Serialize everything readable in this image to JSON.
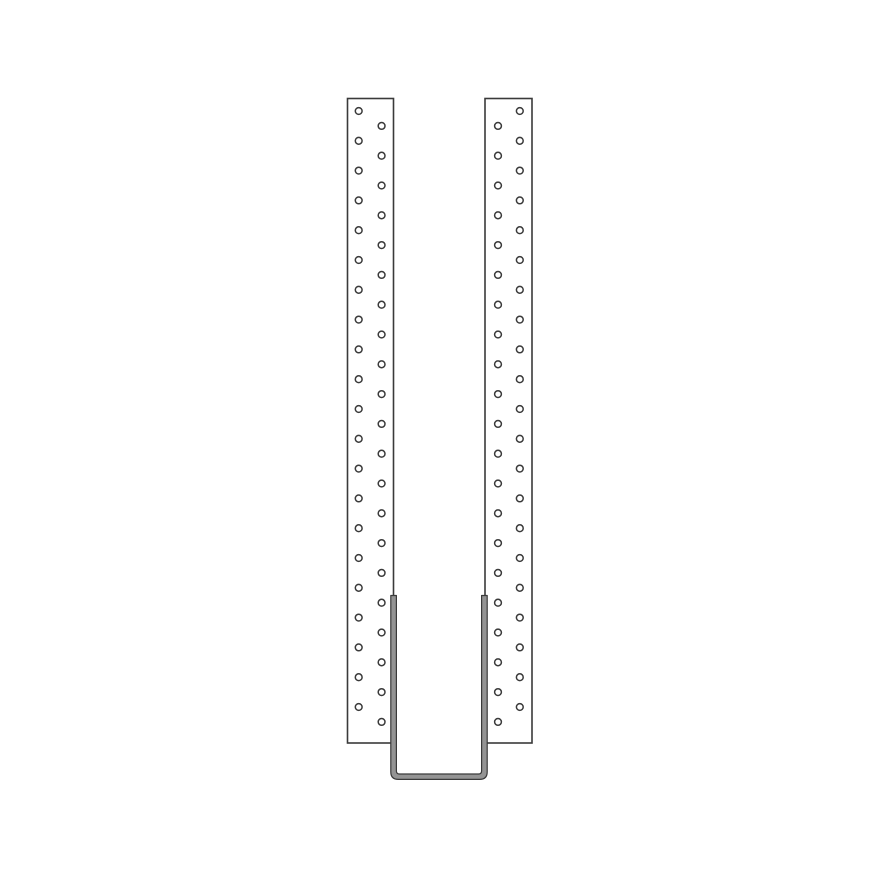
{
  "canvas": {
    "width": 880,
    "height": 880,
    "background_color": "#ffffff"
  },
  "diagram": {
    "kind": "joist-hanger-line-drawing",
    "line_color": "#3a3a3a",
    "plate_fill_color": "#ffffff",
    "strap_fill_color": "#949494",
    "plate_stroke_width": 1.6,
    "hole_stroke_width": 1.5,
    "strap_stroke_width": 1.2,
    "plates": [
      {
        "id": "left-plate",
        "x": 347.5,
        "y": 98.5,
        "width": 46,
        "height": 644.5,
        "outer_hole_col_cx": 358.7,
        "inner_hole_col_cx": 381.6
      },
      {
        "id": "right-plate",
        "x": 485,
        "y": 98.5,
        "width": 47,
        "height": 644.5,
        "outer_hole_col_cx": 519.8,
        "inner_hole_col_cx": 498
      }
    ],
    "holes": {
      "count_per_plate": 42,
      "first_center_y": 111,
      "alternating_step_y": 14.9,
      "radius": 3.4,
      "pattern": "staggered, outer column first"
    },
    "strap": {
      "outer_left_x": 390.8,
      "inner_left_x": 396.4,
      "inner_right_x": 481.6,
      "outer_right_x": 487.2,
      "top_y": 595.5,
      "outer_bottom_y": 779.4,
      "inner_bottom_y": 774,
      "outer_corner_radius": 7.5,
      "inner_corner_radius": 3
    }
  }
}
